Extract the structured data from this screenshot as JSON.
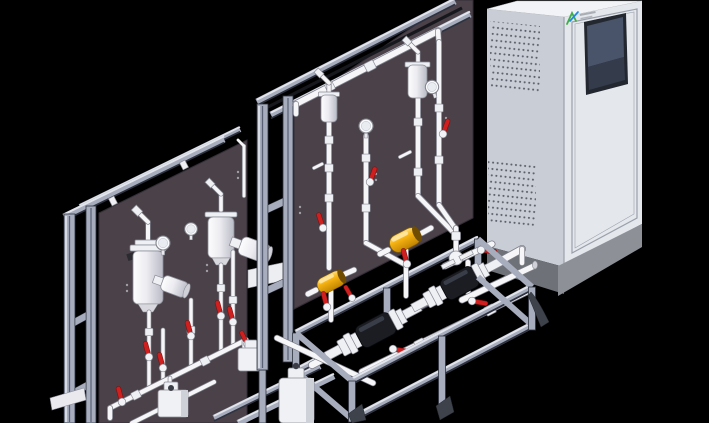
{
  "scene": {
    "type": "3d-cad-render",
    "background": "#000000",
    "description": "Isometric CAD rendering of two aluminum-framed chemical dosing skid assemblies with white piping, red ball valves, pulsation dampeners, pressure gauges, diaphragm pumps and yellow inline dampeners, next to a light-gray control cabinet with an HMI screen, vent grilles and a green-blue brand logo"
  },
  "colors": {
    "bg": "#000000",
    "panel": "#4a4149",
    "panel_edge": "#332d36",
    "alu_light": "#e2e5ec",
    "alu_mid": "#a7adbd",
    "alu_dark": "#2f3340",
    "alu_groove": "#596075",
    "pipe_white": "#f6f6f8",
    "pipe_outline": "#7e7f8a",
    "red": "#d01f1f",
    "red_dark": "#7e1010",
    "yellow": "#f7b414",
    "cab_top": "#f2f3f6",
    "cab_left": "#c9cdd5",
    "cab_front": "#e4e7ec",
    "cab_base": "#8d9097",
    "cab_base_dark": "#6e7177",
    "door_line": "#9aa0aa",
    "screen_dark": "#343b4b",
    "screen_mid": "#49536a",
    "vent_dot": "#5a5f6a",
    "logo_green": "#3fae49",
    "logo_blue": "#1e88e5"
  },
  "cabinet": {
    "label": "control cabinet",
    "screen": "dark HMI panel",
    "vent_grilles": 4,
    "logo": {
      "mark_colors": [
        "#3fae49",
        "#1e88e5"
      ],
      "text_legible": false
    }
  },
  "left_skid": {
    "label": "rear dosing skid",
    "frame": "aluminum extrusion",
    "pulsation_dampeners": 2,
    "pressure_gauges": 2,
    "angled_columns": 2,
    "red_valves": 7,
    "pumps": 2
  },
  "right_skid": {
    "label": "front dosing skid",
    "frame": "aluminum extrusion",
    "pulsation_dampeners": 2,
    "pressure_gauges": 2,
    "yellow_dampeners": 2,
    "red_valves": 9,
    "pumps": 2
  }
}
